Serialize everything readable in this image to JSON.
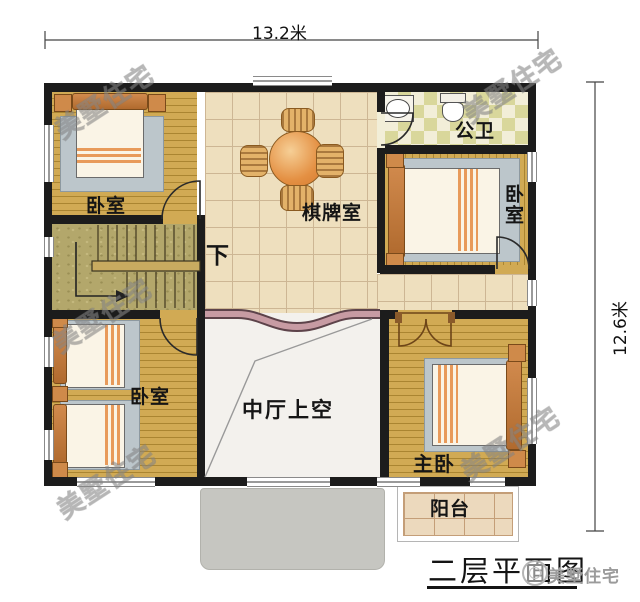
{
  "plan": {
    "title": "二层平面图",
    "dimensions": {
      "width_label": "13.2米",
      "height_label": "12.6米"
    },
    "watermark_text": "美墅住宅",
    "logo": {
      "text": "美墅住宅"
    },
    "rooms": {
      "bedroom_top_left": {
        "label": "卧室"
      },
      "game_room": {
        "label": "棋牌室"
      },
      "stairs": {
        "label": "下"
      },
      "bathroom": {
        "label": "公卫"
      },
      "bedroom_right": {
        "label": "卧室"
      },
      "bedroom_bottom_left": {
        "label": "卧室"
      },
      "void": {
        "label": "中厅上空"
      },
      "master_bedroom": {
        "label": "主卧"
      },
      "balcony": {
        "label": "阳台"
      }
    },
    "colors": {
      "wall": "#1c1c1c",
      "wood": "#d1aa54",
      "wood_line": "#aa8531",
      "tile": "#eedfbe",
      "tile_line": "#cdb694",
      "stair": "#b3a76b",
      "bath_a": "#d9d79b",
      "bath_b": "#f2eed8",
      "void_floor": "#f3f1ed",
      "band": "#c79ba3",
      "canopy": "#c6c6c1",
      "balcony": "#ecd9bd"
    }
  }
}
